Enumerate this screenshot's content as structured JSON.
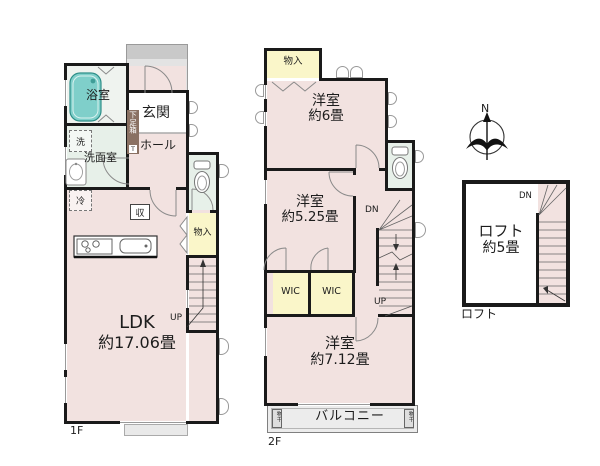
{
  "colors": {
    "wall": "#1a1a1a",
    "pink": "#f2e2e0",
    "yellow": "#faf6c9",
    "green": "#e7f0e9",
    "bathwhite": "#eff3ef",
    "teal": "#7fcfca",
    "porch": "#e3e3e3",
    "band": "#c9c9c9",
    "balcony": "#ececec",
    "brown": "#8a7163"
  },
  "floor1": {
    "floor_label": "1F",
    "bath": "浴室",
    "entrance": "玄関",
    "shoe_box": "下足箱",
    "shoe_box_t": "T",
    "hall": "ホール",
    "washer": "洗",
    "washroom": "洗面室",
    "fridge": "冷",
    "storage": "収",
    "closet": "物入",
    "stairs_up": "UP",
    "ldk_name": "LDK",
    "ldk_area": "約17.06畳"
  },
  "floor2": {
    "floor_label": "2F",
    "closet": "物入",
    "room6_name": "洋室",
    "room6_area": "約6畳",
    "room525_name": "洋室",
    "room525_area": "約5.25畳",
    "wic1": "WIC",
    "wic2": "WIC",
    "stairs_dn": "DN",
    "stairs_up": "UP",
    "room712_name": "洋室",
    "room712_area": "約7.12畳",
    "balcony": "バルコニー",
    "laundry_left": "物干",
    "laundry_right": "物干"
  },
  "loft": {
    "caption": "ロフト",
    "name": "ロフト",
    "area": "約5畳",
    "stairs_dn": "DN",
    "compass_north": "N"
  }
}
